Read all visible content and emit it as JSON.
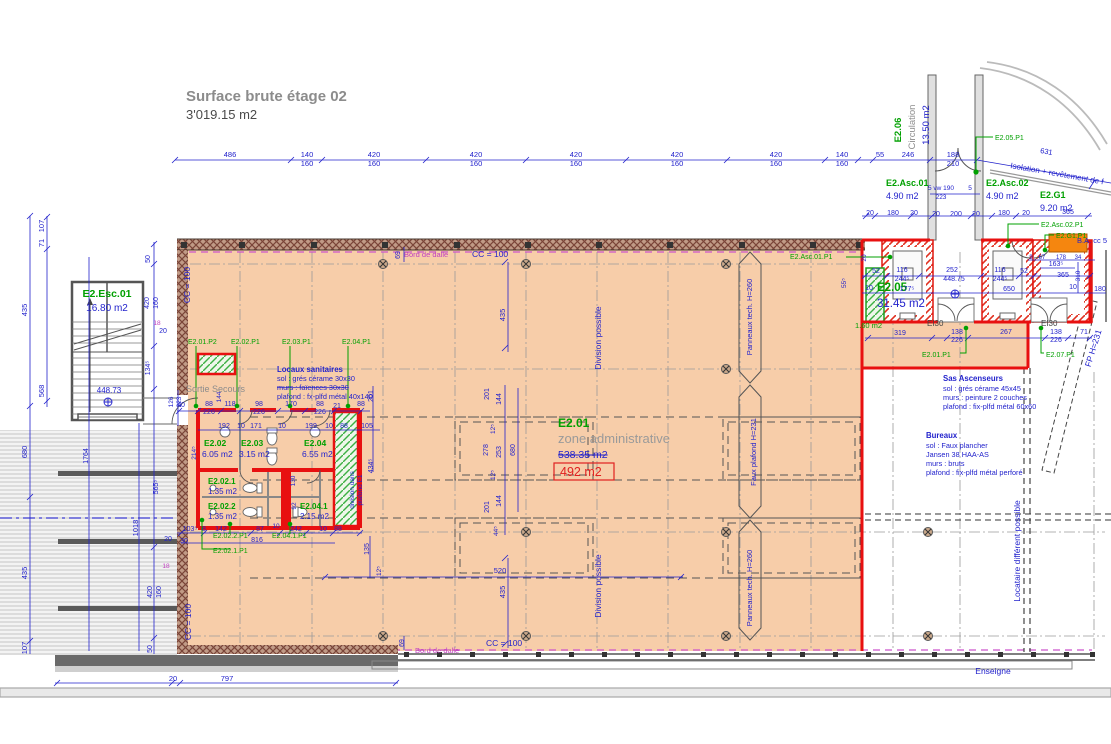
{
  "title": {
    "line1": "Surface brute étage 02",
    "line2": "3'019.15 m2"
  },
  "zone": {
    "id": "E2.01",
    "name": "zone administrative",
    "area_old": "538.35 m2",
    "area_new": "492 m2"
  },
  "notes": {
    "san": {
      "title": "Locaux sanitaires",
      "l1": "sol : grés cérame 30x30",
      "l2": "murs : faïences 30x30",
      "l3": "plafond : fx-plfd métal 40x140"
    },
    "sas": {
      "title": "Sas Ascenseurs",
      "l1": "sol : grés cérame 45x45",
      "l2": "murs : peinture 2 couches",
      "l3": "plafond : fix-plfd métal 60x60"
    },
    "bur": {
      "title": "Bureaux",
      "l1": "sol : Faux plancher",
      "l2": "Jansen 38 HAA-AS",
      "l3": "murs : bruts",
      "l4": "plafond : fix-plfd métal perforé"
    }
  },
  "colors": {
    "b": "#2222cc",
    "g": "#00a000",
    "m": "#c040c0",
    "gy": "#8c8c8c",
    "dk": "#444444",
    "rd": "#e02020"
  },
  "labels": [
    [
      "486",
      230,
      157
    ],
    [
      "140",
      307,
      157
    ],
    [
      "160",
      307,
      166
    ],
    [
      "420",
      374,
      157
    ],
    [
      "160",
      374,
      166
    ],
    [
      "420",
      476,
      157
    ],
    [
      "160",
      476,
      166
    ],
    [
      "420",
      576,
      157
    ],
    [
      "160",
      576,
      166
    ],
    [
      "420",
      677,
      157
    ],
    [
      "160",
      677,
      166
    ],
    [
      "420",
      776,
      157
    ],
    [
      "160",
      776,
      166
    ],
    [
      "140",
      842,
      157
    ],
    [
      "160",
      842,
      166
    ],
    [
      "55",
      880,
      157
    ],
    [
      "246",
      908,
      157
    ],
    [
      "188",
      953,
      157
    ],
    [
      "210",
      953,
      166
    ],
    [
      "631",
      1046,
      154,
      {
        "r": 10
      }
    ],
    [
      "Isolation + revêtement de f",
      1010,
      168,
      {
        "r": 10,
        "a": "start",
        "s": 8
      }
    ],
    [
      "107",
      44,
      226,
      {
        "r": -90
      }
    ],
    [
      "71",
      44,
      243,
      {
        "r": -90
      }
    ],
    [
      "435",
      27,
      310,
      {
        "r": -90
      }
    ],
    [
      "568",
      44,
      391,
      {
        "r": -90
      }
    ],
    [
      "680",
      27,
      452,
      {
        "r": -90
      }
    ],
    [
      "1764",
      88,
      456,
      {
        "r": -90,
        "s": 7
      }
    ],
    [
      "1018",
      138,
      528,
      {
        "r": -90
      }
    ],
    [
      "435",
      27,
      573,
      {
        "r": -90
      }
    ],
    [
      "107",
      27,
      648,
      {
        "r": -90
      }
    ],
    [
      "50",
      150,
      259,
      {
        "r": -90,
        "s": 7
      }
    ],
    [
      "420",
      149,
      303,
      {
        "r": -90,
        "s": 7
      }
    ],
    [
      "160",
      158,
      303,
      {
        "r": -90,
        "s": 7
      }
    ],
    [
      "134⁵",
      150,
      368,
      {
        "r": -90,
        "s": 7
      }
    ],
    [
      "18",
      157,
      325,
      {
        "s": 6.5,
        "c": "m"
      }
    ],
    [
      "20",
      163,
      333,
      {
        "s": 7
      }
    ],
    [
      "565⁵",
      158,
      487,
      {
        "r": -90,
        "s": 7
      }
    ],
    [
      "420",
      152,
      592,
      {
        "r": -90,
        "s": 7
      }
    ],
    [
      "160",
      161,
      592,
      {
        "r": -90,
        "s": 7
      }
    ],
    [
      "50",
      152,
      649,
      {
        "r": -90,
        "s": 7
      }
    ],
    [
      "126",
      173,
      402,
      {
        "r": -90,
        "s": 6.5
      }
    ],
    [
      "223",
      181,
      402,
      {
        "r": -90,
        "s": 6.5
      }
    ],
    [
      "20",
      168,
      541,
      {
        "s": 7
      }
    ],
    [
      "30",
      184,
      543,
      {
        "s": 7
      }
    ],
    [
      "18",
      166,
      568,
      {
        "s": 6.5,
        "c": "m"
      }
    ],
    [
      "797",
      227,
      681
    ],
    [
      "20",
      173,
      681
    ],
    [
      "69",
      400,
      255,
      {
        "r": -90,
        "s": 7
      }
    ],
    [
      "69",
      404,
      643,
      {
        "r": -90,
        "s": 7
      }
    ],
    [
      "CC = 100",
      472,
      257,
      {
        "a": "start",
        "s": 8.5
      }
    ],
    [
      "CC = 100",
      190,
      285,
      {
        "r": -90,
        "s": 8.5
      }
    ],
    [
      "CC = 100",
      191,
      622,
      {
        "r": -90,
        "s": 8.5
      }
    ],
    [
      "CC = 100",
      486,
      646,
      {
        "a": "start",
        "s": 8.5
      }
    ],
    [
      "Bord de dalle",
      404,
      257,
      {
        "a": "start",
        "s": 7.5,
        "c": "m"
      }
    ],
    [
      "Bord de dalle",
      415,
      653,
      {
        "a": "start",
        "s": 7.5,
        "c": "m"
      }
    ],
    [
      "448.73",
      109,
      393,
      {
        "s": 8
      }
    ],
    [
      "Division possible",
      601,
      338,
      {
        "r": -90,
        "s": 8.5
      }
    ],
    [
      "Division possible",
      601,
      586,
      {
        "r": -90,
        "s": 8.5
      }
    ],
    [
      "Panneaux tech. H=260",
      752,
      317,
      {
        "r": -90,
        "s": 7.5
      }
    ],
    [
      "Panneaux tech. H=260",
      752,
      588,
      {
        "r": -90,
        "s": 7.5
      }
    ],
    [
      "Faux plafond H=231",
      756,
      452,
      {
        "r": -90,
        "s": 7.5
      }
    ],
    [
      "Locataire différent possible",
      1020,
      551,
      {
        "r": -90,
        "s": 8.5
      }
    ],
    [
      "FP  H=231",
      1096,
      349,
      {
        "r": -73,
        "s": 8.5
      }
    ],
    [
      "Enseigne",
      993,
      674,
      {
        "s": 8.5
      }
    ],
    [
      "B.A. cc 5",
      1077,
      243,
      {
        "a": "start",
        "s": 7.5
      }
    ],
    [
      "EI30",
      927,
      326,
      {
        "a": "start",
        "s": 8,
        "c": "dk"
      }
    ],
    [
      "EI30",
      1041,
      326,
      {
        "a": "start",
        "s": 8,
        "c": "dk"
      }
    ],
    [
      "Sortie Secours",
      186,
      392,
      {
        "a": "start",
        "s": 9,
        "c": "gy"
      }
    ],
    [
      "5 vw 190",
      928,
      190,
      {
        "a": "start",
        "s": 6.5
      }
    ],
    [
      "223",
      941,
      199,
      {
        "s": 6.5
      }
    ],
    [
      "5",
      970,
      190,
      {
        "s": 6.5
      }
    ],
    [
      "E2.Esc.01",
      107,
      297,
      {
        "s": 10.5,
        "c": "g",
        "w": 1
      }
    ],
    [
      "16.80 m2",
      107,
      311,
      {
        "s": 10
      }
    ],
    [
      "E2.06",
      901,
      130,
      {
        "r": -90,
        "s": 9.5,
        "c": "g",
        "w": 1
      }
    ],
    [
      "Circulation",
      915,
      127,
      {
        "r": -90,
        "s": 9.5,
        "c": "gy"
      }
    ],
    [
      "13.50 m2",
      929,
      125,
      {
        "r": -90,
        "s": 9.5
      }
    ],
    [
      "E2.Asc.01",
      886,
      186,
      {
        "a": "start",
        "s": 9,
        "c": "g",
        "w": 1
      }
    ],
    [
      "4.90 m2",
      886,
      199,
      {
        "a": "start",
        "s": 9
      }
    ],
    [
      "E2.Asc.02",
      986,
      186,
      {
        "a": "start",
        "s": 9,
        "c": "g",
        "w": 1
      }
    ],
    [
      "4.90 m2",
      986,
      199,
      {
        "a": "start",
        "s": 9
      }
    ],
    [
      "E2.G1",
      1040,
      198,
      {
        "a": "start",
        "s": 9,
        "c": "g",
        "w": 1
      }
    ],
    [
      "9.20 m2",
      1040,
      211,
      {
        "a": "start",
        "s": 9
      }
    ],
    [
      "E2.05",
      877,
      291,
      {
        "a": "start",
        "s": 11.5,
        "c": "g",
        "w": 1
      }
    ],
    [
      "31.45 m2",
      877,
      307,
      {
        "a": "start",
        "s": 11.5
      }
    ],
    [
      "E2.02",
      204,
      446,
      {
        "a": "start",
        "s": 8.5,
        "c": "g",
        "w": 1
      }
    ],
    [
      "6.05 m2",
      202,
      457,
      {
        "a": "start",
        "s": 8.5
      }
    ],
    [
      "E2.03",
      241,
      446,
      {
        "a": "start",
        "s": 8.5,
        "c": "g",
        "w": 1
      }
    ],
    [
      "3.15 m2",
      239,
      457,
      {
        "a": "start",
        "s": 8.5
      }
    ],
    [
      "E2.04",
      304,
      446,
      {
        "a": "start",
        "s": 8.5,
        "c": "g",
        "w": 1
      }
    ],
    [
      "6.55 m2",
      302,
      457,
      {
        "a": "start",
        "s": 8.5
      }
    ],
    [
      "E2.02.1",
      208,
      484,
      {
        "a": "start",
        "s": 8,
        "c": "g",
        "w": 1
      }
    ],
    [
      "1.35 m2",
      208,
      494,
      {
        "a": "start",
        "s": 8
      }
    ],
    [
      "E2.02.2",
      208,
      509,
      {
        "a": "start",
        "s": 8,
        "c": "g",
        "w": 1
      }
    ],
    [
      "1.35 m2",
      208,
      519,
      {
        "a": "start",
        "s": 8
      }
    ],
    [
      "E2.04.1",
      300,
      509,
      {
        "a": "start",
        "s": 8,
        "c": "g",
        "w": 1
      }
    ],
    [
      "2.15 m2",
      300,
      519,
      {
        "a": "start",
        "s": 8
      }
    ],
    [
      "1.60 m2",
      855,
      328,
      {
        "a": "start",
        "s": 7.5,
        "c": "g"
      }
    ],
    [
      "E2.01.P2",
      188,
      344,
      {
        "a": "start",
        "s": 7,
        "c": "g"
      }
    ],
    [
      "E2.02.P1",
      231,
      344,
      {
        "a": "start",
        "s": 7,
        "c": "g"
      }
    ],
    [
      "E2.03.P1",
      282,
      344,
      {
        "a": "start",
        "s": 7,
        "c": "g"
      }
    ],
    [
      "E2.04.P1",
      342,
      344,
      {
        "a": "start",
        "s": 7,
        "c": "g"
      }
    ],
    [
      "E2.05.P1",
      995,
      140,
      {
        "a": "start",
        "s": 7,
        "c": "g"
      }
    ],
    [
      "E2.Asc.01.P1",
      790,
      259,
      {
        "a": "start",
        "s": 7,
        "c": "g"
      }
    ],
    [
      "E2.Asc.02.P1",
      1041,
      227,
      {
        "a": "start",
        "s": 7,
        "c": "g"
      }
    ],
    [
      "E2.G1.P1",
      1056,
      238,
      {
        "a": "start",
        "s": 7,
        "c": "g"
      }
    ],
    [
      "E2.01.P1",
      922,
      357,
      {
        "a": "start",
        "s": 7,
        "c": "g"
      }
    ],
    [
      "E2.07.P1",
      1046,
      357,
      {
        "a": "start",
        "s": 7,
        "c": "g"
      }
    ],
    [
      "E2.02.2.P1",
      213,
      538,
      {
        "a": "start",
        "s": 7,
        "c": "g"
      }
    ],
    [
      "E2.04.1.P1",
      272,
      538,
      {
        "a": "start",
        "s": 7,
        "c": "g"
      }
    ],
    [
      "E2.02.1.P1",
      213,
      553,
      {
        "a": "start",
        "s": 7,
        "c": "g"
      }
    ],
    [
      "40",
      181,
      407,
      {
        "s": 7
      }
    ],
    [
      "88",
      209,
      406,
      {
        "s": 7
      }
    ],
    [
      "226",
      209,
      414,
      {
        "s": 7
      }
    ],
    [
      "118",
      230,
      406,
      {
        "s": 7
      }
    ],
    [
      "98",
      259,
      406,
      {
        "s": 7
      }
    ],
    [
      "226",
      259,
      414,
      {
        "s": 7
      }
    ],
    [
      "170",
      291,
      406,
      {
        "s": 7
      }
    ],
    [
      "88",
      320,
      406,
      {
        "s": 7
      }
    ],
    [
      "226",
      320,
      414,
      {
        "s": 7
      }
    ],
    [
      "21",
      337,
      408,
      {
        "s": 7
      }
    ],
    [
      "88",
      361,
      406,
      {
        "s": 7
      }
    ],
    [
      "192",
      224,
      428,
      {
        "s": 7
      }
    ],
    [
      "10",
      241,
      428,
      {
        "s": 7
      }
    ],
    [
      "171",
      256,
      428,
      {
        "s": 7
      }
    ],
    [
      "10",
      282,
      428,
      {
        "s": 7
      }
    ],
    [
      "199",
      311,
      428,
      {
        "s": 7
      }
    ],
    [
      "10",
      329,
      428,
      {
        "s": 7
      }
    ],
    [
      "88",
      344,
      428,
      {
        "s": 7
      }
    ],
    [
      "105",
      367,
      428,
      {
        "s": 7
      }
    ],
    [
      "144",
      221,
      397,
      {
        "r": -90,
        "s": 6.5
      }
    ],
    [
      "201",
      373,
      396,
      {
        "r": -90,
        "s": 7
      }
    ],
    [
      "434⁵",
      373,
      466,
      {
        "r": -90,
        "s": 7
      }
    ],
    [
      "214⁵",
      196,
      453,
      {
        "r": -90,
        "s": 6.5
      }
    ],
    [
      "92",
      296,
      506,
      {
        "r": -90,
        "s": 6.5
      }
    ],
    [
      "130",
      295,
      481,
      {
        "r": -90,
        "s": 6.5
      }
    ],
    [
      "103⁵",
      190,
      531,
      {
        "s": 7
      }
    ],
    [
      "8",
      204,
      531,
      {
        "s": 7
      }
    ],
    [
      "142",
      221,
      531,
      {
        "s": 7
      }
    ],
    [
      "87",
      260,
      531,
      {
        "s": 7
      }
    ],
    [
      "10",
      276,
      528,
      {
        "s": 6.5
      }
    ],
    [
      "242",
      296,
      531,
      {
        "s": 7
      }
    ],
    [
      "10",
      323,
      531,
      {
        "s": 7
      }
    ],
    [
      "88",
      338,
      531,
      {
        "s": 7
      }
    ],
    [
      "816",
      257,
      542,
      {
        "s": 7
      }
    ],
    [
      "520",
      500,
      573,
      {
        "s": 7.5
      }
    ],
    [
      "135",
      369,
      549,
      {
        "r": -90,
        "s": 7
      }
    ],
    [
      "12⁵",
      381,
      571,
      {
        "r": -90,
        "s": 6.5
      }
    ],
    [
      "division dans",
      354,
      490,
      {
        "r": -90,
        "s": 6.5
      }
    ],
    [
      "plafond E1",
      362,
      490,
      {
        "r": -90,
        "s": 6.5
      }
    ],
    [
      "435",
      505,
      315,
      {
        "r": -90
      }
    ],
    [
      "201",
      489,
      394,
      {
        "r": -90,
        "s": 7
      }
    ],
    [
      "144",
      501,
      399,
      {
        "r": -90,
        "s": 7
      }
    ],
    [
      "12⁵",
      495,
      429,
      {
        "r": -90,
        "s": 6.5
      }
    ],
    [
      "278",
      488,
      450,
      {
        "r": -90,
        "s": 7
      }
    ],
    [
      "253",
      501,
      452,
      {
        "r": -90,
        "s": 7
      }
    ],
    [
      "680",
      515,
      450,
      {
        "r": -90,
        "s": 7
      }
    ],
    [
      "12⁵",
      495,
      475,
      {
        "r": -90,
        "s": 6.5
      }
    ],
    [
      "144",
      501,
      501,
      {
        "r": -90,
        "s": 7
      }
    ],
    [
      "201",
      489,
      507,
      {
        "r": -90,
        "s": 7
      }
    ],
    [
      "44⁵",
      498,
      531,
      {
        "r": -90,
        "s": 6.5
      }
    ],
    [
      "435",
      505,
      592,
      {
        "r": -90
      }
    ],
    [
      "20",
      870,
      215,
      {
        "s": 7
      }
    ],
    [
      "180",
      893,
      215,
      {
        "s": 7
      }
    ],
    [
      "20",
      914,
      215,
      {
        "s": 7
      }
    ],
    [
      "20",
      936,
      216,
      {
        "s": 7
      }
    ],
    [
      "200",
      956,
      216,
      {
        "s": 7
      }
    ],
    [
      "20",
      976,
      216,
      {
        "s": 7
      }
    ],
    [
      "180",
      1004,
      215,
      {
        "s": 7
      }
    ],
    [
      "20",
      1026,
      215,
      {
        "s": 7
      }
    ],
    [
      "365",
      1068,
      214,
      {
        "s": 7
      }
    ],
    [
      "52",
      876,
      273,
      {
        "s": 7
      }
    ],
    [
      "116",
      902,
      272,
      {
        "s": 7
      }
    ],
    [
      "244⁵",
      902,
      281,
      {
        "s": 7
      }
    ],
    [
      "252",
      952,
      272,
      {
        "s": 7
      }
    ],
    [
      "448.75",
      954,
      281,
      {
        "s": 7
      }
    ],
    [
      "116",
      1000,
      272,
      {
        "s": 7
      }
    ],
    [
      "244⁵",
      1000,
      281,
      {
        "s": 7
      }
    ],
    [
      "52",
      1024,
      273,
      {
        "s": 7
      }
    ],
    [
      "365",
      1063,
      277,
      {
        "s": 7
      }
    ],
    [
      "10",
      869,
      290,
      {
        "s": 7
      }
    ],
    [
      "177⁵",
      907,
      291,
      {
        "s": 7
      }
    ],
    [
      "650",
      1009,
      291,
      {
        "s": 7
      }
    ],
    [
      "10",
      1073,
      289,
      {
        "s": 7
      }
    ],
    [
      "180",
      1100,
      291,
      {
        "s": 7
      }
    ],
    [
      "163⁵",
      1056,
      266,
      {
        "s": 7
      }
    ],
    [
      "310",
      1080,
      276,
      {
        "r": -90,
        "s": 6.5
      }
    ],
    [
      "9",
      1031,
      259,
      {
        "s": 6
      }
    ],
    [
      "67",
      1042,
      259,
      {
        "s": 6
      }
    ],
    [
      "178",
      1061,
      259,
      {
        "s": 6
      }
    ],
    [
      "34",
      1078,
      259,
      {
        "s": 6
      }
    ],
    [
      "20",
      866,
      258,
      {
        "r": -90,
        "s": 6.5
      }
    ],
    [
      "55⁵",
      846,
      283,
      {
        "r": -90,
        "s": 6.5
      }
    ],
    [
      "319",
      900,
      335,
      {
        "s": 7
      }
    ],
    [
      "138",
      957,
      334,
      {
        "s": 7
      }
    ],
    [
      "226",
      957,
      342,
      {
        "s": 7
      }
    ],
    [
      "267",
      1006,
      334,
      {
        "s": 7
      }
    ],
    [
      "138",
      1056,
      334,
      {
        "s": 7
      }
    ],
    [
      "226",
      1056,
      342,
      {
        "s": 7
      }
    ],
    [
      "71",
      1084,
      334,
      {
        "s": 7
      }
    ]
  ]
}
